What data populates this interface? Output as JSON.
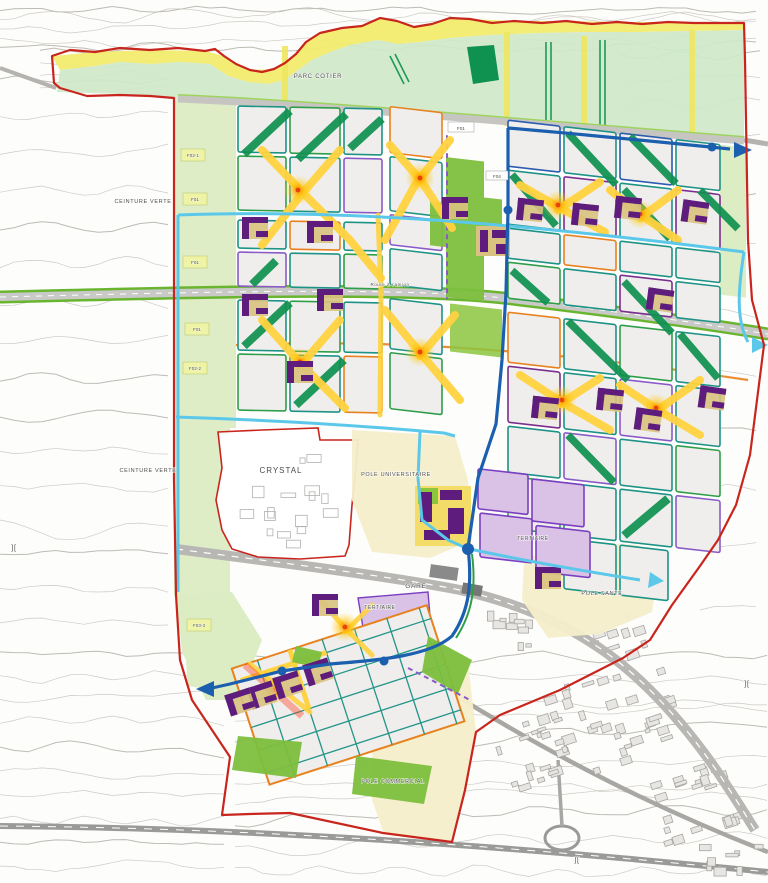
{
  "map": {
    "title": "Urban masterplan",
    "labels": {
      "parc_cotier": "PARC COTIER",
      "ceinture_verte_top": "CEINTURE VERTE",
      "ceinture_verte_left": "CEINTURE VERTE",
      "crystal": "CRYSTAL",
      "pole_universitaire": "POLE UNIVERSITAIRE",
      "gare": "GARE",
      "tertiaire_1": "TERTIAIRE",
      "tertiaire_2": "TERTIAIRE",
      "pole_sante": "POLE SANTE",
      "pole_commercial": "POLE COMMERCIAL",
      "route_a_camion": "Route à camion",
      "f01_park": "F01",
      "f02_1": "F02-1",
      "f01_a": "F01",
      "f01_b": "F01",
      "f01_c": "F01",
      "f02_2": "F02-2",
      "f03_3": "F03-3",
      "f04": "F04",
      "bridge_mark": "]["
    },
    "colors": {
      "boundary_red": "#c8251d",
      "coastal_park_green": "#cfe8c9",
      "coast_dune_yellow": "#f2ec6e",
      "greenway_dark_green": "#0f9150",
      "park_bright_green": "#7dbf3e",
      "block_fill": "#efeeec",
      "block_outline_teal": "#1d9386",
      "block_outline_purple": "#7a2e8e",
      "block_outline_orange": "#e8821e",
      "boulevard_yellow": "#ffd23f",
      "building_purple": "#5e1d7c",
      "tertiaire_lilac": "#d9c2e6",
      "pole_cream": "#f6eecb",
      "transit_blue": "#1b5fae",
      "transit_cyan": "#5bc8ea",
      "rail_gray": "#b9b7b4",
      "contour_gray": "#c6c2ba"
    }
  }
}
